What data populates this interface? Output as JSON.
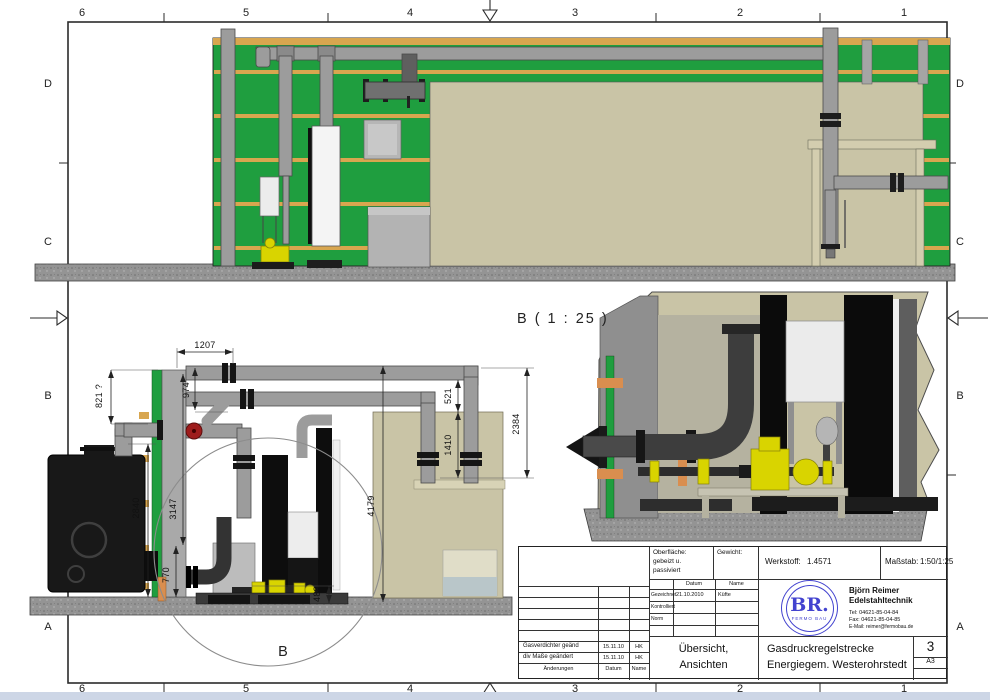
{
  "frame": {
    "top_numbers": [
      "6",
      "5",
      "4",
      "3",
      "2",
      "1"
    ],
    "bottom_numbers": [
      "6",
      "5",
      "4",
      "3",
      "2",
      "1"
    ],
    "left_letters": [
      "D",
      "C",
      "B",
      "A"
    ],
    "right_letters": [
      "D",
      "C",
      "B",
      "A"
    ]
  },
  "annotations": {
    "detail_view_label": "B ( 1 : 25 )",
    "detail_circle_letter": "B"
  },
  "dimensions": {
    "dim_1207": "1207",
    "dim_974": "974",
    "dim_821": "821 ?",
    "dim_2840": "2840",
    "dim_3147": "3147",
    "dim_770": "770",
    "dim_4179": "4179",
    "dim_521": "521",
    "dim_1410": "1410",
    "dim_2384": "2384",
    "dim_488": "488"
  },
  "title_block": {
    "surface_label": "Oberfläche:",
    "surface_value_line1": "gebeizt u.",
    "surface_value_line2": "passiviert",
    "weight_label": "Gewicht:",
    "material_label": "Werkstoff:",
    "material_value": "1.4571",
    "scale_label": "Maßstab:",
    "scale_value": "1:50/1:25",
    "sign_table": {
      "col_date": "Datum",
      "col_name": "Name",
      "row_drawn_label": "Gezeichnet",
      "row_drawn_date": "21.10.2010",
      "row_drawn_name": "Küfte",
      "row_checked_label": "Kontrolliert",
      "row_norm_label": "Norm"
    },
    "logo_text": "BR.",
    "logo_subtext": "FERMO BAU",
    "company_line1": "Björn Reimer",
    "company_line2": "Edelstahltechnik",
    "company_tel": "Tel: 04621-85-04-84",
    "company_fax": "Fax: 04621-85-04-85",
    "company_email": "E-Mail: reimer@fermobau.de",
    "doc_title_line1": "Übersicht,",
    "doc_title_line2": "Ansichten",
    "project_line1": "Gasdruckregelstrecke",
    "project_line2": "Energiegem. Westerohrstedt",
    "sheet_number": "3",
    "sheet_format": "A3",
    "revisions": [
      {
        "desc": "Gasverdichter geänd",
        "date": "15.11.10",
        "name": "HK"
      },
      {
        "desc": "div Maße geändert",
        "date": "15.11.10",
        "name": "HK"
      }
    ],
    "revision_footer_desc": "Änderungen",
    "revision_footer_date": "Datum",
    "revision_footer_name": "Name"
  },
  "colors": {
    "wall_green": "#1f9e3f",
    "stripe_tan": "#d8a64f",
    "khaki": "#c9c4a6",
    "pipe_gray": "#9c9c9c",
    "valve_yellow": "#d9d400",
    "logo_blue": "#4343cf",
    "contact_blue": "#4a4fd8"
  }
}
